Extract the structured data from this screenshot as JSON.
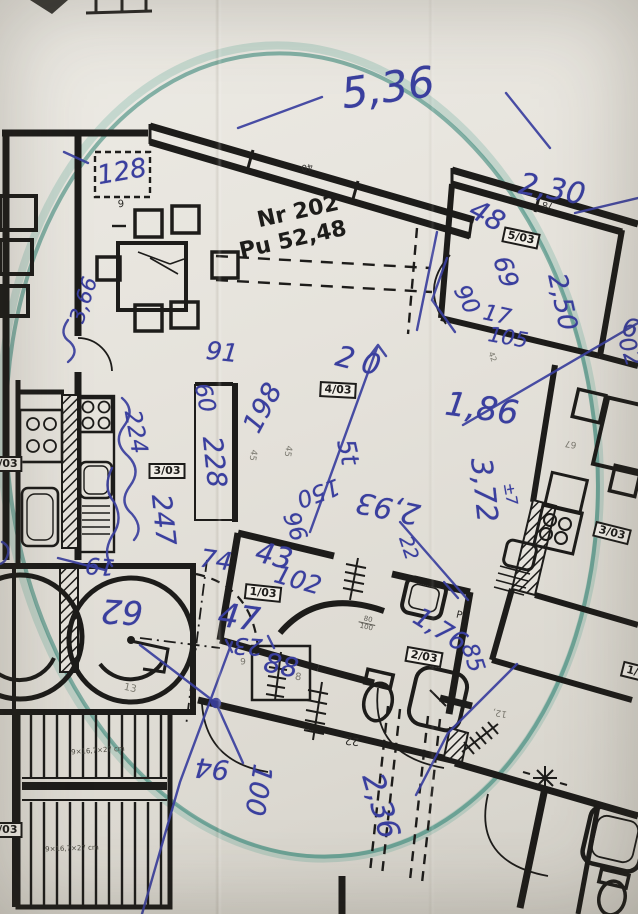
{
  "document_kind": "architectural floor plan photo with handwritten survey notes",
  "apartment": {
    "number_label": "Nr 202",
    "area_label": "Pu 52,48"
  },
  "colors": {
    "pen": "#3a3f9e",
    "marker_ellipse": "#2e8273",
    "ink": "#1d1c1a",
    "paper": "#e6e3dc"
  },
  "room_tags": [
    {
      "name": "room-tag-5-03",
      "kind": "tag",
      "text": "5/03",
      "x": 521,
      "y": 238,
      "rot": 12,
      "size": 11
    },
    {
      "name": "room-tag-4-03",
      "kind": "tag",
      "text": "4/03",
      "x": 338,
      "y": 390,
      "rot": 3,
      "size": 11
    },
    {
      "name": "room-tag-3-03-left",
      "kind": "tag",
      "text": "3/03",
      "x": 167,
      "y": 471,
      "rot": 0,
      "size": 11
    },
    {
      "name": "room-tag-3-03-right",
      "kind": "tag",
      "text": "3/03",
      "x": 612,
      "y": 533,
      "rot": 14,
      "size": 11
    },
    {
      "name": "room-tag-1-03",
      "kind": "tag",
      "text": "1/03",
      "x": 263,
      "y": 593,
      "rot": 6,
      "size": 11
    },
    {
      "name": "room-tag-2-03",
      "kind": "tag",
      "text": "2/03",
      "x": 424,
      "y": 657,
      "rot": 10,
      "size": 11
    },
    {
      "name": "room-tag-partial-right",
      "kind": "tag",
      "text": "1/0",
      "x": 636,
      "y": 672,
      "rot": 14,
      "size": 11
    },
    {
      "name": "room-tag-partial-left",
      "kind": "tag",
      "text": "/03",
      "x": 8,
      "y": 464,
      "rot": 0,
      "size": 11
    },
    {
      "name": "room-tag-partial-stairs",
      "kind": "tag",
      "text": "4/03",
      "x": 4,
      "y": 830,
      "rot": 0,
      "size": 11
    }
  ],
  "annotations": [
    {
      "name": "pen-dim",
      "kind": "pen",
      "text": "5,36",
      "x": 388,
      "y": 88,
      "rot": -8,
      "size": 42
    },
    {
      "name": "pen-dim",
      "kind": "pen",
      "text": "128",
      "x": 122,
      "y": 172,
      "rot": -10,
      "size": 26
    },
    {
      "name": "pen-dim",
      "kind": "pen",
      "text": "3,66",
      "x": 84,
      "y": 300,
      "rot": -72,
      "size": 21
    },
    {
      "name": "pen-dim",
      "kind": "pen",
      "text": "2,30",
      "x": 552,
      "y": 190,
      "rot": 10,
      "size": 30
    },
    {
      "name": "pen-dim",
      "kind": "pen",
      "text": "48",
      "x": 487,
      "y": 216,
      "rot": 28,
      "size": 28
    },
    {
      "name": "pen-dim",
      "kind": "pen",
      "text": "69",
      "x": 506,
      "y": 272,
      "rot": 72,
      "size": 25
    },
    {
      "name": "pen-dim",
      "kind": "pen",
      "text": "2,50",
      "x": 562,
      "y": 302,
      "rot": 78,
      "size": 26
    },
    {
      "name": "pen-dim",
      "kind": "pen",
      "text": "90",
      "x": 466,
      "y": 300,
      "rot": 62,
      "size": 23
    },
    {
      "name": "pen-dim",
      "kind": "pen",
      "text": "17",
      "x": 497,
      "y": 316,
      "rot": 12,
      "size": 22
    },
    {
      "name": "pen-dim",
      "kind": "pen",
      "text": "105",
      "x": 508,
      "y": 338,
      "rot": 10,
      "size": 21
    },
    {
      "name": "pen-dim",
      "kind": "pen",
      "text": "20",
      "x": 362,
      "y": 362,
      "rot": 14,
      "size": 29,
      "ls": 8
    },
    {
      "name": "pen-dim",
      "kind": "pen",
      "text": "1,86",
      "x": 482,
      "y": 408,
      "rot": 8,
      "size": 33
    },
    {
      "name": "pen-dim",
      "kind": "pen",
      "text": "3,72",
      "x": 484,
      "y": 490,
      "rot": 84,
      "size": 29
    },
    {
      "name": "pen-dim",
      "kind": "pen",
      "text": "±7",
      "x": 510,
      "y": 494,
      "rot": 80,
      "size": 15
    },
    {
      "name": "pen-dim",
      "kind": "pen",
      "text": "91",
      "x": 222,
      "y": 352,
      "rot": 6,
      "size": 25
    },
    {
      "name": "pen-dim",
      "kind": "pen",
      "text": "60",
      "x": 204,
      "y": 398,
      "rot": 78,
      "size": 23
    },
    {
      "name": "pen-dim",
      "kind": "pen",
      "text": "228",
      "x": 214,
      "y": 462,
      "rot": 84,
      "size": 27
    },
    {
      "name": "pen-dim",
      "kind": "pen",
      "text": "198",
      "x": 263,
      "y": 408,
      "rot": -62,
      "size": 27
    },
    {
      "name": "pen-dim",
      "kind": "pen",
      "text": "150",
      "x": 318,
      "y": 492,
      "rot": 160,
      "size": 23
    },
    {
      "name": "pen-dim",
      "kind": "pen",
      "text": "96",
      "x": 294,
      "y": 527,
      "rot": 70,
      "size": 23
    },
    {
      "name": "pen-dim",
      "kind": "pen",
      "text": "2,93",
      "x": 388,
      "y": 508,
      "rot": 192,
      "size": 29
    },
    {
      "name": "pen-dim",
      "kind": "pen",
      "text": "5t",
      "x": 348,
      "y": 452,
      "rot": 78,
      "size": 25
    },
    {
      "name": "pen-dim",
      "kind": "pen",
      "text": "22",
      "x": 408,
      "y": 548,
      "rot": 72,
      "size": 19
    },
    {
      "name": "pen-dim",
      "kind": "pen",
      "text": "74",
      "x": 216,
      "y": 560,
      "rot": 8,
      "size": 25
    },
    {
      "name": "pen-dim",
      "kind": "pen",
      "text": "43",
      "x": 274,
      "y": 556,
      "rot": 14,
      "size": 29
    },
    {
      "name": "pen-dim",
      "kind": "pen",
      "text": "102",
      "x": 298,
      "y": 580,
      "rot": 16,
      "size": 25
    },
    {
      "name": "pen-dim",
      "kind": "pen",
      "text": "47",
      "x": 239,
      "y": 617,
      "rot": 8,
      "size": 33
    },
    {
      "name": "pen-dim",
      "kind": "pen",
      "text": "19",
      "x": 100,
      "y": 565,
      "rot": 185,
      "size": 23
    },
    {
      "name": "pen-dim",
      "kind": "pen",
      "text": "23",
      "x": 248,
      "y": 645,
      "rot": 183,
      "size": 23
    },
    {
      "name": "pen-dim",
      "kind": "pen",
      "text": "88",
      "x": 281,
      "y": 666,
      "rot": 12,
      "size": 27
    },
    {
      "name": "pen-dim",
      "kind": "pen",
      "text": "247",
      "x": 163,
      "y": 520,
      "rot": 84,
      "size": 27
    },
    {
      "name": "pen-dim",
      "kind": "pen",
      "text": "224",
      "x": 135,
      "y": 432,
      "rot": 80,
      "size": 23
    },
    {
      "name": "pen-dim",
      "kind": "pen",
      "text": "94",
      "x": 212,
      "y": 768,
      "rot": 185,
      "size": 27
    },
    {
      "name": "pen-dim",
      "kind": "pen",
      "text": "100",
      "x": 258,
      "y": 790,
      "rot": 100,
      "size": 27
    },
    {
      "name": "pen-dim",
      "kind": "pen",
      "text": "2,36",
      "x": 380,
      "y": 806,
      "rot": 74,
      "size": 30
    },
    {
      "name": "pen-dim",
      "kind": "pen",
      "text": "85",
      "x": 472,
      "y": 658,
      "rot": 72,
      "size": 23
    },
    {
      "name": "pen-dim",
      "kind": "pen",
      "text": "1,76",
      "x": 440,
      "y": 630,
      "rot": 32,
      "size": 26
    },
    {
      "name": "pen-dim",
      "kind": "pen",
      "text": "6",
      "x": 630,
      "y": 328,
      "rot": 10,
      "size": 25
    },
    {
      "name": "pen-dim",
      "kind": "pen",
      "text": "02",
      "x": 629,
      "y": 352,
      "rot": 72,
      "size": 23
    },
    {
      "name": "pen-dim",
      "kind": "pen",
      "text": "62",
      "x": 122,
      "y": 612,
      "rot": 183,
      "size": 33
    }
  ],
  "printed": [
    {
      "name": "printed-dim",
      "kind": "print",
      "text": "40",
      "x": 307,
      "y": 166,
      "rot": 172,
      "size": 9
    },
    {
      "name": "printed-dim",
      "kind": "print",
      "text": "78",
      "x": 548,
      "y": 204,
      "rot": 188,
      "size": 9
    },
    {
      "name": "printed-dim",
      "kind": "print",
      "text": "9",
      "x": 121,
      "y": 205,
      "rot": -4,
      "size": 10
    },
    {
      "name": "printed-dim",
      "kind": "print faint",
      "text": "42",
      "x": 492,
      "y": 357,
      "rot": 70,
      "size": 8
    },
    {
      "name": "printed-dim",
      "kind": "print faint",
      "text": "45",
      "x": 252,
      "y": 455,
      "rot": 100,
      "size": 9
    },
    {
      "name": "printed-dim",
      "kind": "print faint",
      "text": "45",
      "x": 287,
      "y": 451,
      "rot": 100,
      "size": 9
    },
    {
      "name": "printed-dim",
      "kind": "print faint",
      "text": "67",
      "x": 571,
      "y": 443,
      "rot": 190,
      "size": 9
    },
    {
      "name": "printed-dim",
      "kind": "print",
      "text": "22",
      "x": 352,
      "y": 741,
      "rot": 186,
      "size": 11
    },
    {
      "name": "printed-dim",
      "kind": "print faint",
      "text": "12,",
      "x": 500,
      "y": 712,
      "rot": 190,
      "size": 9
    },
    {
      "name": "printed-dim",
      "kind": "print faint",
      "text": "13",
      "x": 130,
      "y": 689,
      "rot": 12,
      "size": 10
    },
    {
      "name": "printed-dim",
      "kind": "print faint",
      "text": "8",
      "x": 298,
      "y": 678,
      "rot": 8,
      "size": 10
    },
    {
      "name": "printed-dim",
      "kind": "print faint",
      "text": "9",
      "x": 243,
      "y": 663,
      "rot": 0,
      "size": 9
    },
    {
      "name": "printed-letter",
      "kind": "print",
      "text": "P",
      "x": 459,
      "y": 616,
      "rot": 13,
      "size": 10
    },
    {
      "name": "stair-spec-label",
      "kind": "print",
      "text": "9×16,7×27 cm",
      "x": 98,
      "y": 751,
      "rot": -4,
      "size": 7,
      "color": "#4a4840"
    },
    {
      "name": "stair-spec-label",
      "kind": "print",
      "text": "9×16,7×27 cm",
      "x": 72,
      "y": 849,
      "rot": -2,
      "size": 7,
      "color": "#4a4840"
    }
  ],
  "fraction_note": {
    "name": "sink-size-fraction",
    "num": "80",
    "den": "100",
    "x": 367,
    "y": 624,
    "rot": 13
  }
}
